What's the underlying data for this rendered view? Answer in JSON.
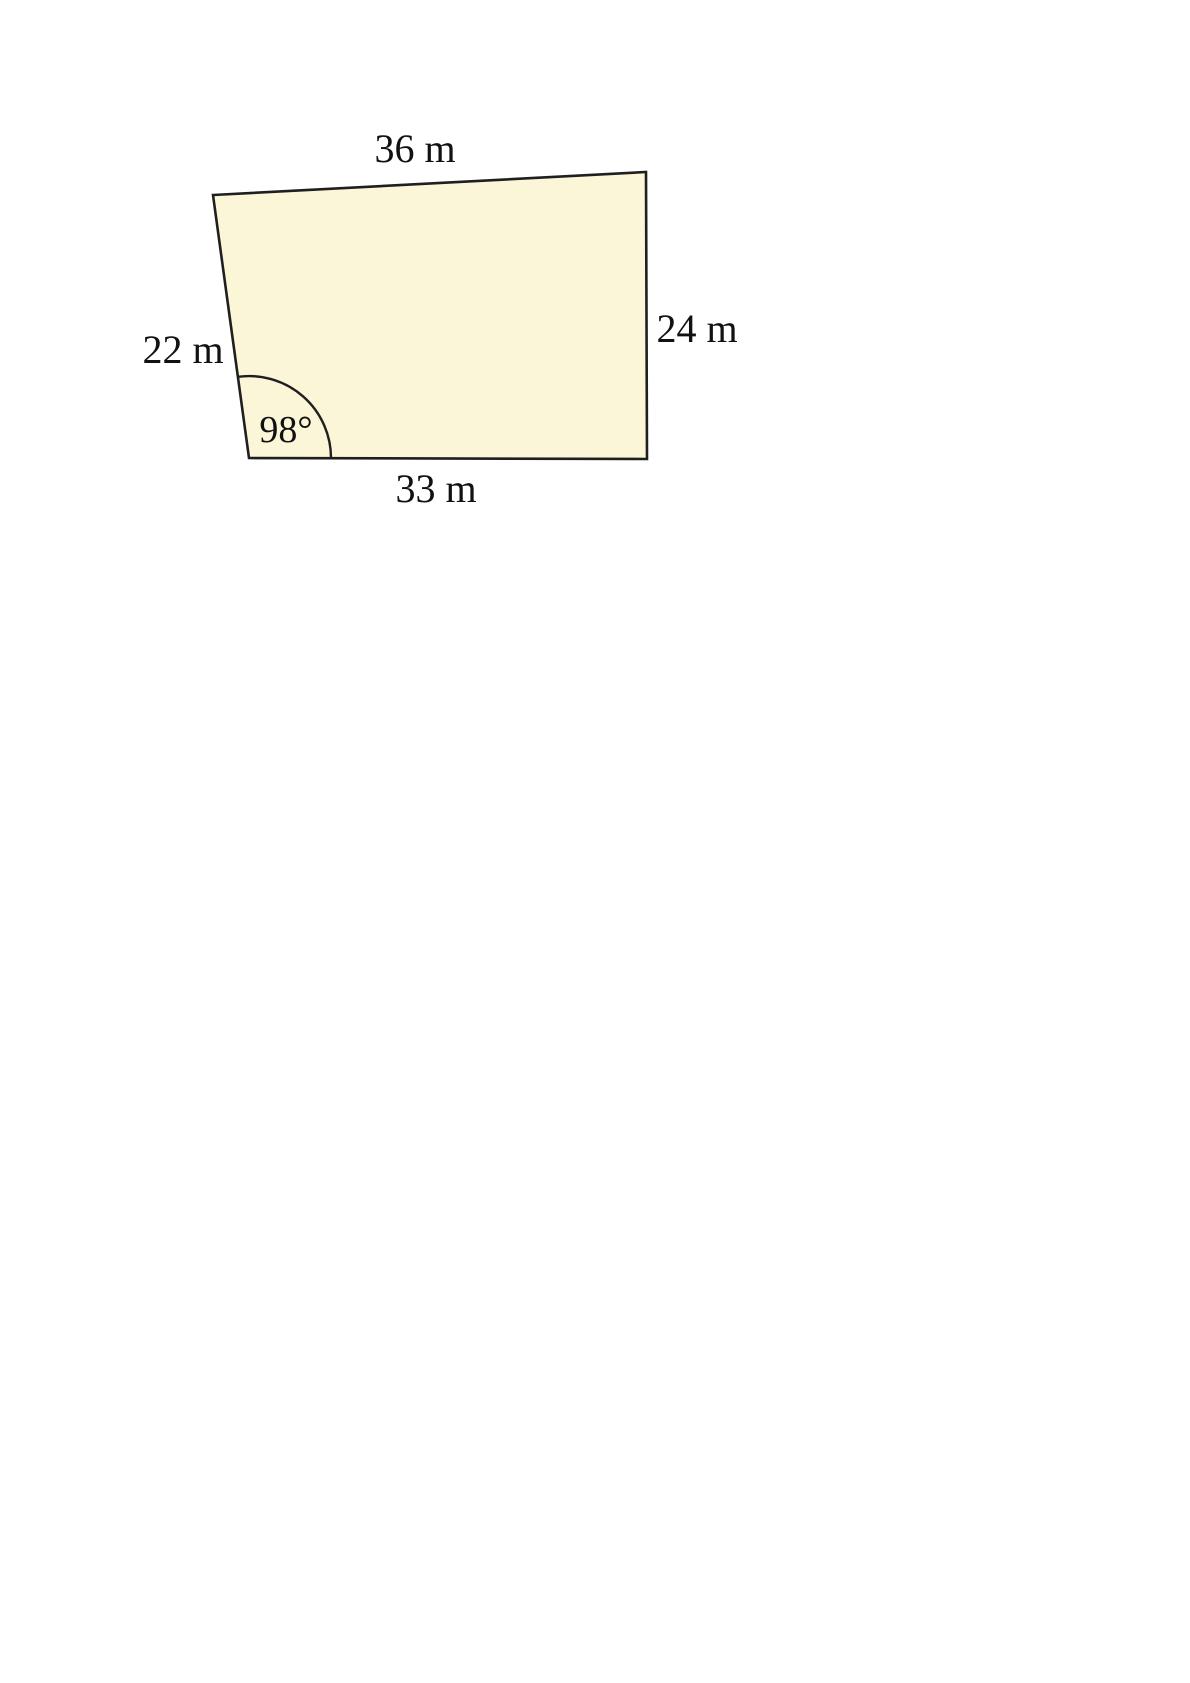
{
  "figure": {
    "type": "quadrilateral",
    "description": "Quadrilateral (field diagram) with four labeled side lengths and one marked interior angle at the bottom-left vertex",
    "fill_color": "#FCF6D8",
    "stroke_color": "#1F1F1F",
    "labels": {
      "top_side": "36 m",
      "right_side": "24 m",
      "bottom_side": "33 m",
      "left_side": "22 m",
      "angle": "98°"
    },
    "values": {
      "top_side_m": 36,
      "right_side_m": 24,
      "bottom_side_m": 33,
      "left_side_m": 22,
      "angle_degrees": 98,
      "angle_vertex": "bottom-left interior"
    }
  }
}
